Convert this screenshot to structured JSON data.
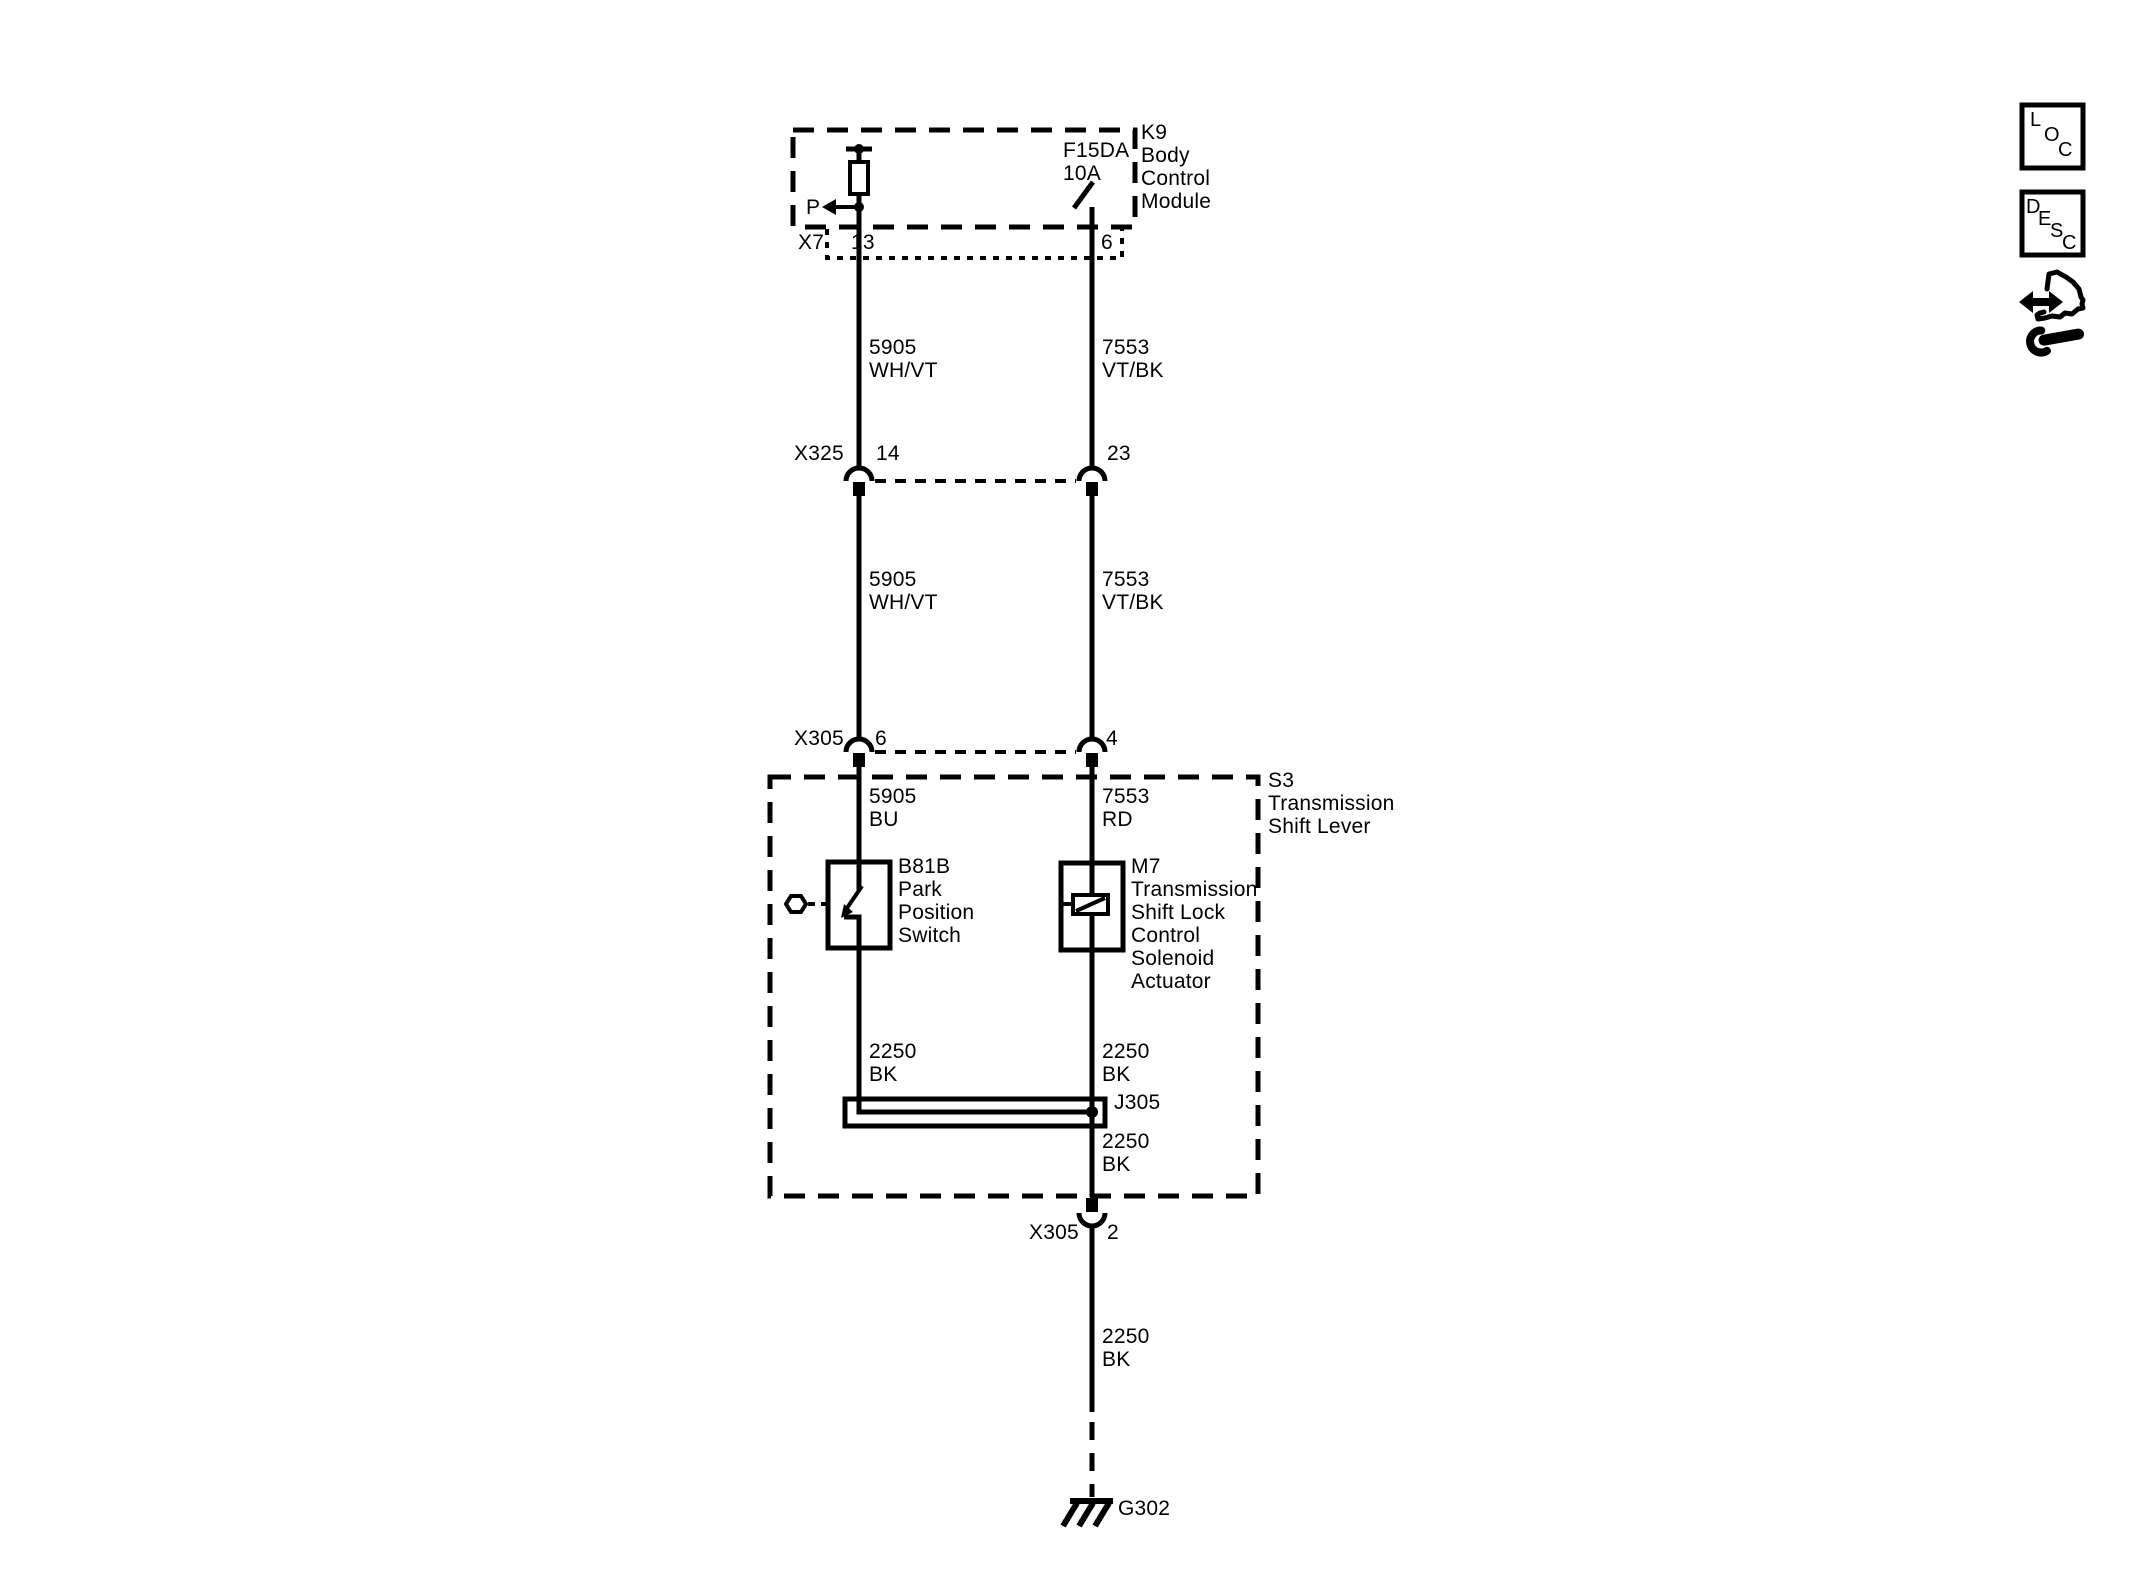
{
  "colors": {
    "ink": "#000000",
    "paper": "#ffffff"
  },
  "components": {
    "bcm": {
      "ref": "K9",
      "name": "Body\nControl\nModule"
    },
    "fuse": {
      "name": "F15DA\n10A"
    },
    "shift_lever": {
      "ref": "S3",
      "name": "Transmission\nShift Lever"
    },
    "park_switch": {
      "ref": "B81B",
      "name": "Park\nPosition\nSwitch"
    },
    "solenoid": {
      "ref": "M7",
      "name": "Transmission\nShift Lock\nControl\nSolenoid\nActuator"
    },
    "splice": {
      "ref": "J305"
    },
    "ground": {
      "ref": "G302"
    },
    "park_signal": "P"
  },
  "connectors": {
    "x7": {
      "label": "X7",
      "pin_left": "13",
      "pin_right": "6"
    },
    "x325": {
      "label": "X325",
      "pin_left": "14",
      "pin_right": "23"
    },
    "x305": {
      "label": "X305",
      "pin_left": "6",
      "pin_right": "4"
    },
    "x305_ground": {
      "label": "X305",
      "pin": "2"
    }
  },
  "wires": {
    "left_upper": "5905\nWH/VT",
    "right_upper": "7553\nVT/BK",
    "left_mid": "5905\nWH/VT",
    "right_mid": "7553\nVT/BK",
    "left_lever": "5905\nBU",
    "right_lever": "7553\nRD",
    "left_ground": "2250\nBK",
    "right_ground": "2250\nBK",
    "splice_out": "2250\nBK",
    "ground_run": "2250\nBK"
  },
  "sidebar": {
    "loc": [
      "L",
      "O",
      "C"
    ],
    "desc": [
      "D",
      "E",
      "S",
      "C"
    ]
  }
}
